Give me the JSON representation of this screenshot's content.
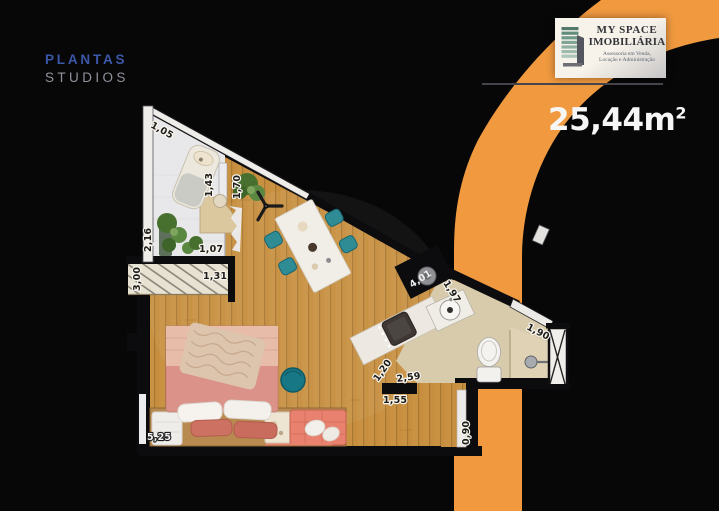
{
  "brand": {
    "line1": "PLANTAS",
    "line2": "STUDIOS"
  },
  "logo": {
    "name_line1": "MY SPACE",
    "name_line2": "IMOBILIÁRIA",
    "tagline_line1": "Assessoria em Venda,",
    "tagline_line2": "Locação e Administração"
  },
  "area": {
    "value": "25,44m",
    "superscript": "2"
  },
  "floorplan": {
    "measurements": [
      {
        "id": "wall-top-left",
        "text": "1,05"
      },
      {
        "id": "office-rail",
        "text": "1,43"
      },
      {
        "id": "office-depth",
        "text": "1,70"
      },
      {
        "id": "balcony-window",
        "text": "2,16"
      },
      {
        "id": "balcony-width",
        "text": "1,07"
      },
      {
        "id": "deck-length",
        "text": "3,00"
      },
      {
        "id": "deck-width",
        "text": "1,31"
      },
      {
        "id": "living-length",
        "text": "5,25"
      },
      {
        "id": "kitchen-counter",
        "text": "4,01"
      },
      {
        "id": "kitchen-depth",
        "text": "1,97"
      },
      {
        "id": "bath-window",
        "text": "1,90"
      },
      {
        "id": "counter-width",
        "text": "1,20"
      },
      {
        "id": "bath-length",
        "text": "2,59"
      },
      {
        "id": "hall-width",
        "text": "1,55"
      },
      {
        "id": "entry-door",
        "text": "0,90"
      }
    ]
  },
  "colors": {
    "accent_orange": "#F0993F",
    "brand_blue": "#3A57A8",
    "brand_gray": "#90939B",
    "background": "#070708",
    "wood_floor": "#C68E3E",
    "teal_furniture": "#2F8C95"
  }
}
